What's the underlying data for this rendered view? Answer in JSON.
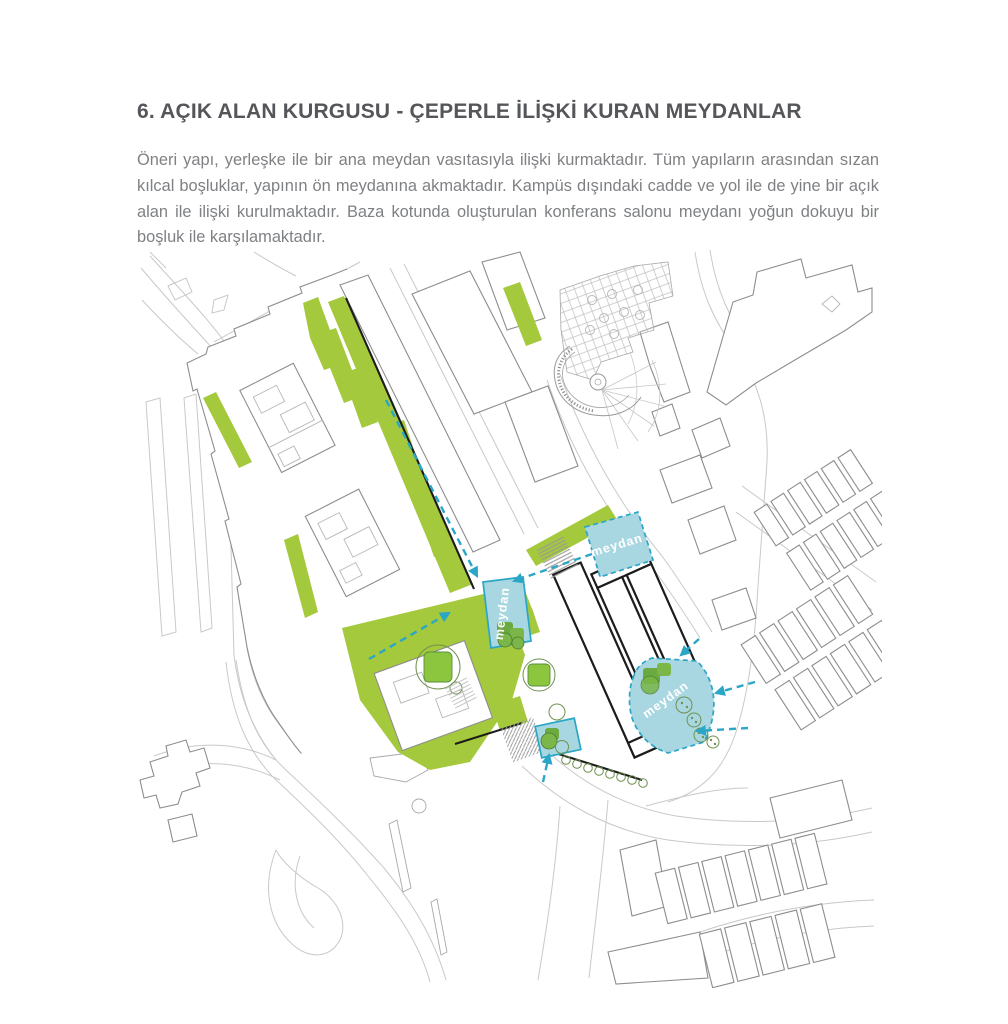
{
  "page": {
    "title": "6. AÇIK ALAN KURGUSU - ÇEPERLE İLİŞKİ KURAN MEYDANLAR",
    "paragraph": "Öneri yapı, yerleşke ile bir ana meydan vasıtasıyla ilişki kurmaktadır. Tüm yapıların arasından sızan kılcal boşluklar, yapının ön meydanına akmaktadır. Kampüs dışındaki cadde ve yol ile de yine bir açık alan ile ilişki kurulmaktadır. Baza kotunda oluşturulan konferans salonu meydanı yoğun dokuyu bir boşluk ile karşılamaktadır."
  },
  "map": {
    "meydan_labels": [
      "meydan",
      "meydan",
      "meydan"
    ]
  },
  "palette": {
    "green": "#a4c93c",
    "plaza": "#a9d7e1",
    "teal": "#2aa6c6",
    "heading": "#55565a",
    "body": "#7e8083",
    "ink": "#1c1c1c",
    "outline": "#8d8d8d",
    "road": "#c9c9c9"
  }
}
